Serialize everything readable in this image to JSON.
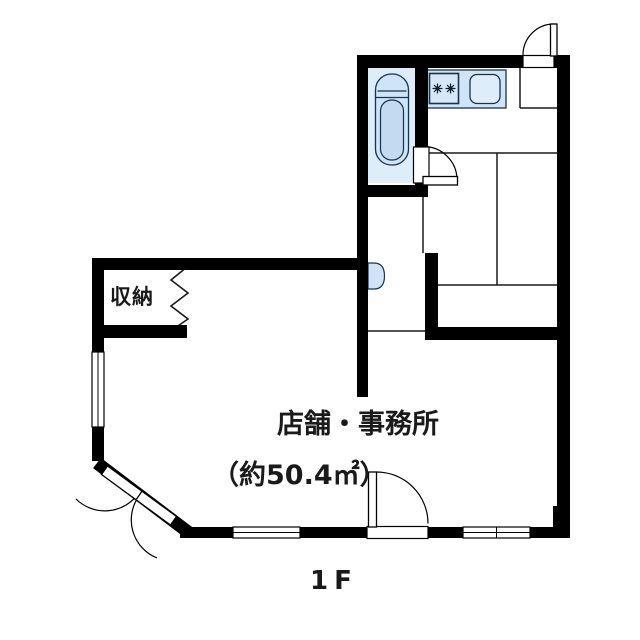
{
  "floorplan": {
    "floor_label": "1F",
    "rooms": {
      "storage": {
        "label": "収納"
      },
      "shop_office": {
        "label": "店舗・事務所",
        "area": "（約50.4㎡）"
      }
    },
    "icons": {
      "stove_burner": "gas-burner-star",
      "door_swing": "quarter-circle-arc",
      "open_closet": "zigzag-no-door"
    },
    "colors": {
      "wall": "#000000",
      "line": "#1a1a1a",
      "fixture_fill": "#cfe4f7",
      "fixture_fill_light": "#deedfa",
      "fixture_fill_dark": "#c3daf0",
      "background": "#ffffff"
    }
  }
}
